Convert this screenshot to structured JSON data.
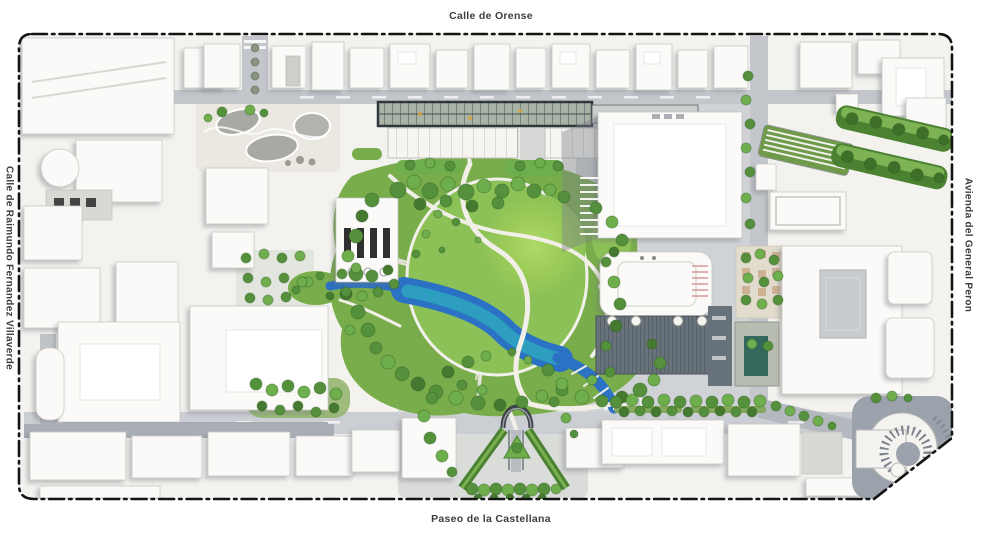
{
  "map": {
    "streets": {
      "top": "Calle de Orense",
      "bottom": "Paseo de la Castellana",
      "left": "Calle de Raimundo Fernandez Villaverde",
      "right": "Avienda del General Peron"
    },
    "colors": {
      "background": "#ffffff",
      "frame_border": "#141414",
      "label_text": "#3d3d3d",
      "ground": "#f3f2ef",
      "street": "#c3c6cb",
      "plaza": "#d0d3d6",
      "building": "#fbfaf8",
      "park_green": "#79ad4b",
      "lawn_green": "#8cc157",
      "mound_green": "#aeda67",
      "tree_green": "#55913c",
      "tree_light": "#6fae4c",
      "hedge_green": "#4a8232",
      "water_deep": "#2b72c4",
      "water_shallow": "#2ea3bf",
      "path": "#f1efe8",
      "canopy_frame": "#2f363c",
      "facade_dark": "#68727b"
    }
  }
}
